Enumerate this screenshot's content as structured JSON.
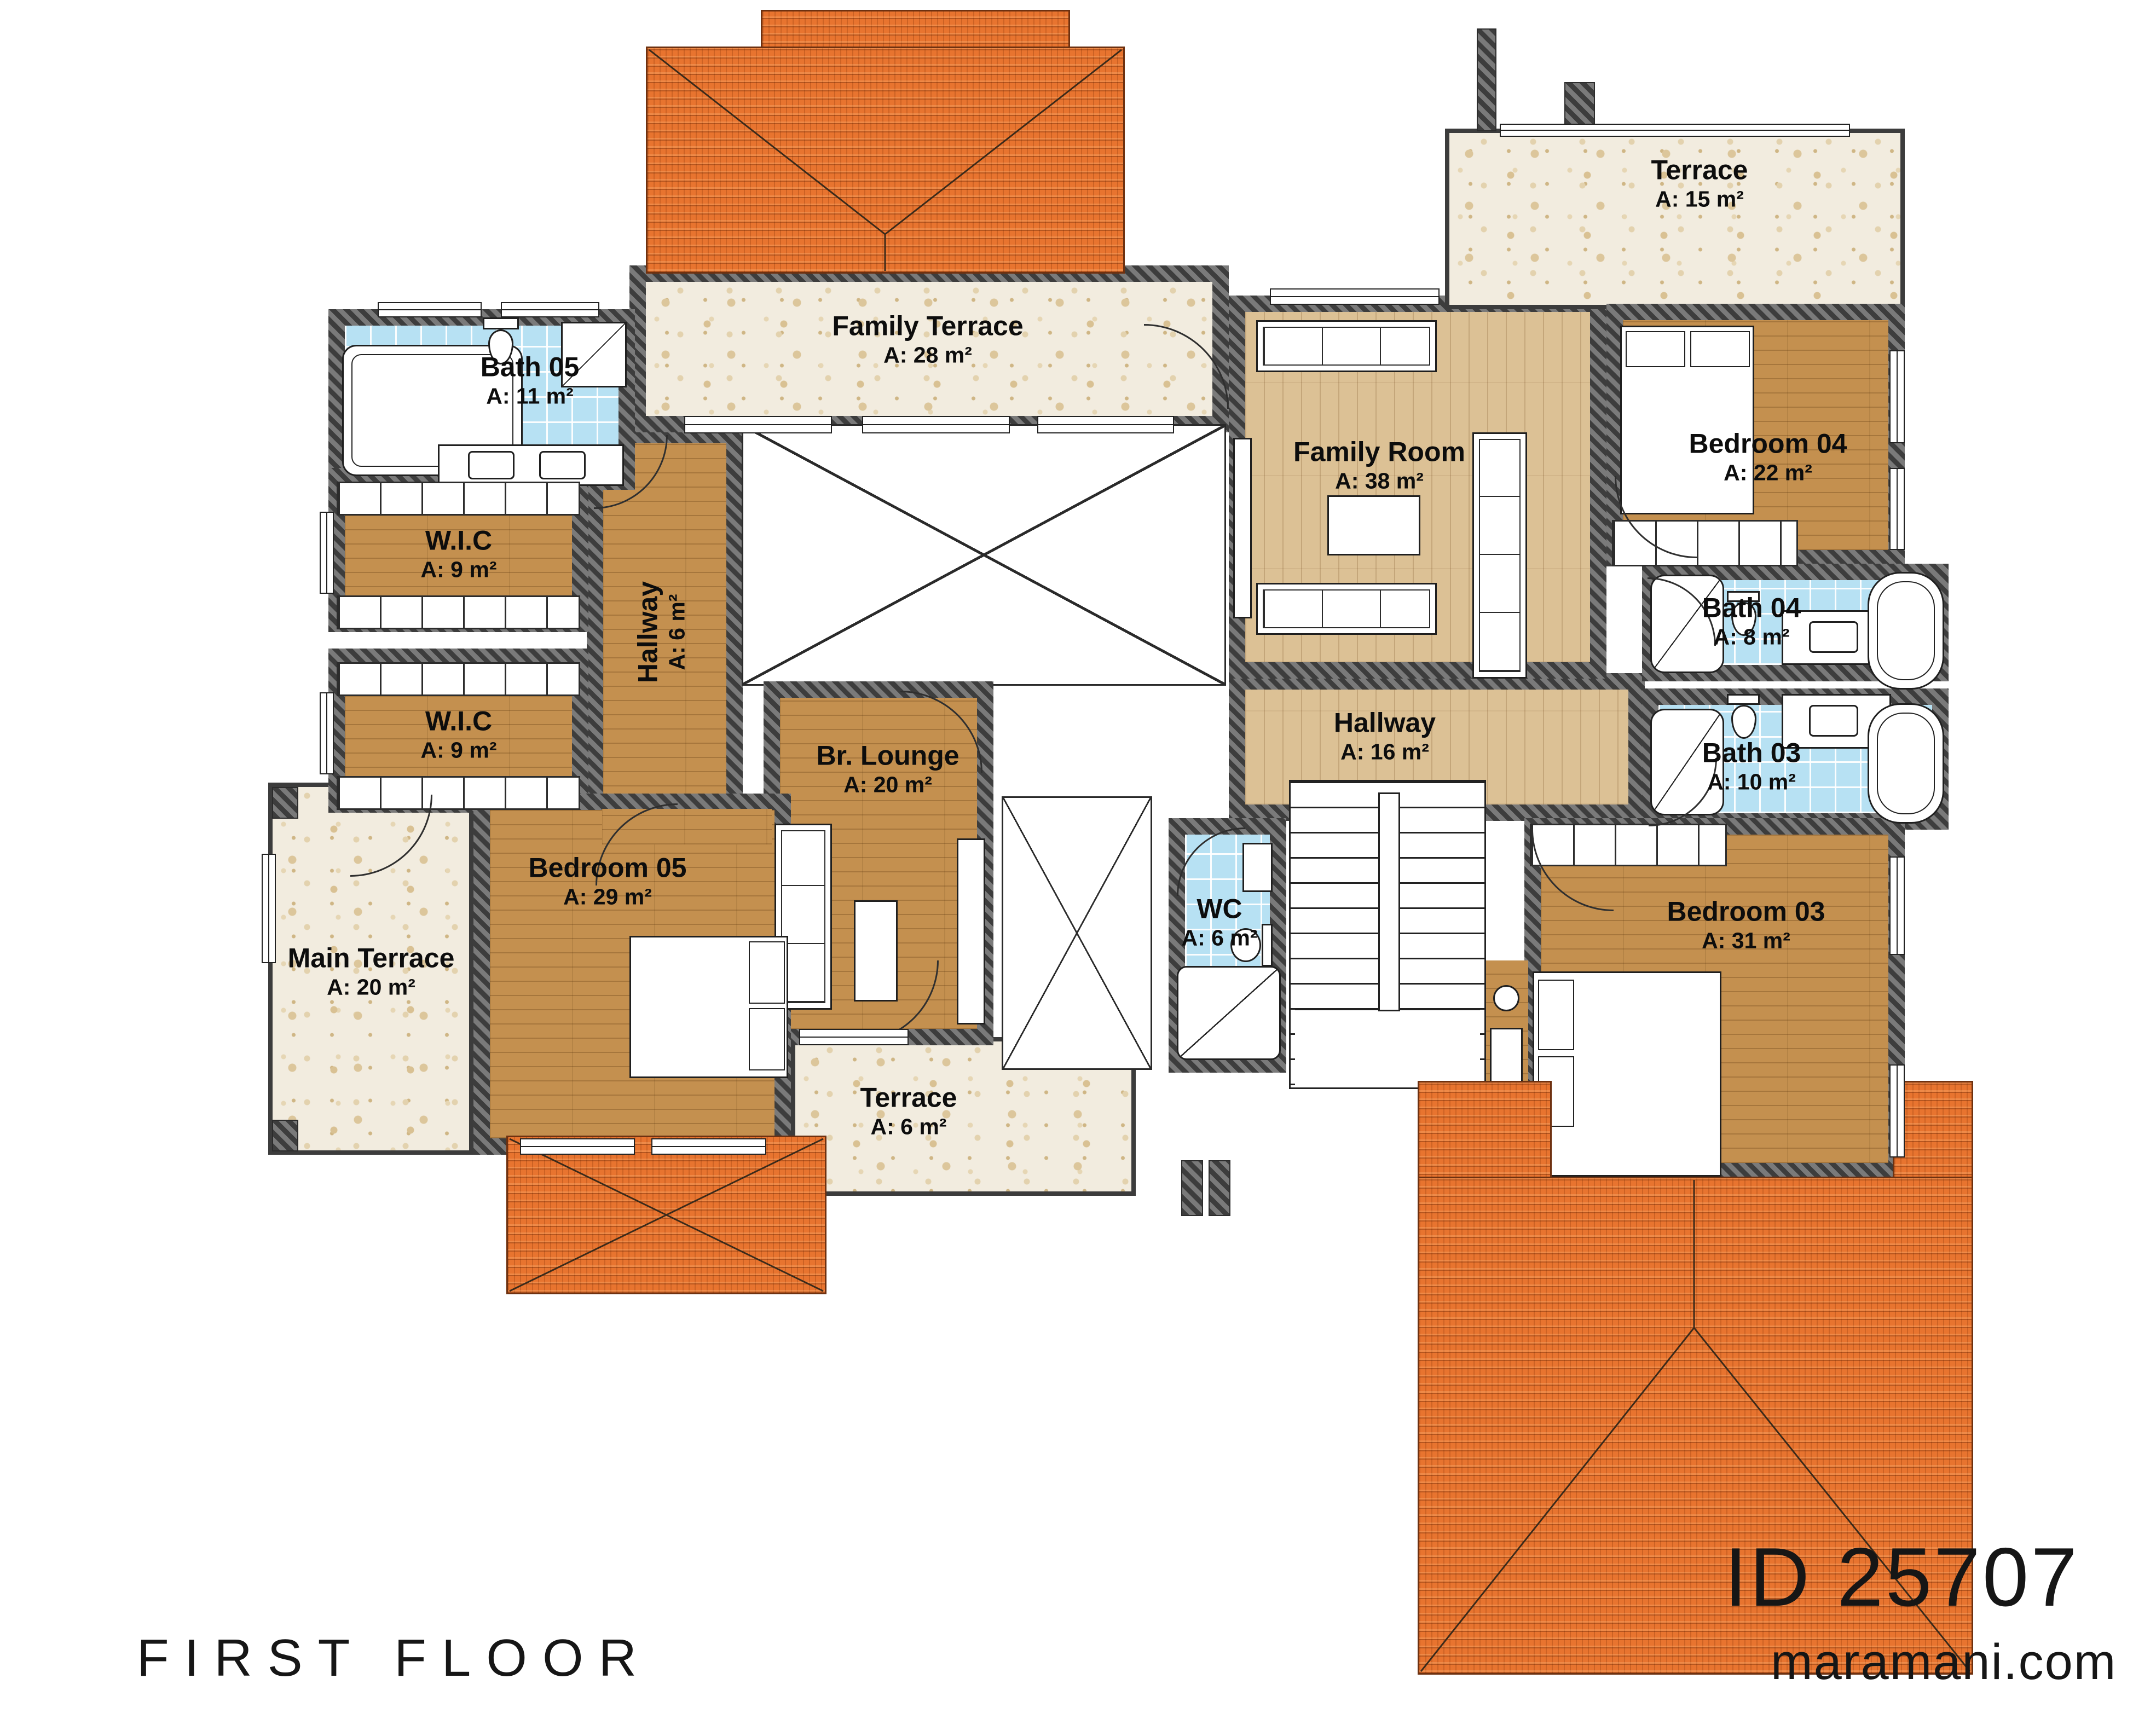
{
  "title_block": {
    "floor_label": "FIRST FLOOR",
    "plan_id": "ID 25707",
    "website": "maramani.com"
  },
  "rooms": [
    {
      "key": "bath-05",
      "name": "Bath 05",
      "area": "A: 11 m²"
    },
    {
      "key": "wic-upper",
      "name": "W.I.C",
      "area": "A: 9 m²"
    },
    {
      "key": "wic-lower",
      "name": "W.I.C",
      "area": "A: 9 m²"
    },
    {
      "key": "hallway-small",
      "name": "Hallway",
      "area": "A: 6 m²"
    },
    {
      "key": "family-terrace",
      "name": "Family Terrace",
      "area": "A: 28 m²"
    },
    {
      "key": "family-room",
      "name": "Family Room",
      "area": "A: 38 m²"
    },
    {
      "key": "terrace-upper",
      "name": "Terrace",
      "area": "A: 15 m²"
    },
    {
      "key": "bedroom-04",
      "name": "Bedroom 04",
      "area": "A: 22 m²"
    },
    {
      "key": "bath-04",
      "name": "Bath 04",
      "area": "A: 8 m²"
    },
    {
      "key": "bath-03",
      "name": "Bath 03",
      "area": "A: 10 m²"
    },
    {
      "key": "hallway-main",
      "name": "Hallway",
      "area": "A: 16 m²"
    },
    {
      "key": "br-lounge",
      "name": "Br. Lounge",
      "area": "A: 20 m²"
    },
    {
      "key": "bedroom-05",
      "name": "Bedroom 05",
      "area": "A: 29 m²"
    },
    {
      "key": "main-terrace",
      "name": "Main Terrace",
      "area": "A: 20 m²"
    },
    {
      "key": "wc",
      "name": "WC",
      "area": "A: 6 m²"
    },
    {
      "key": "terrace-lower",
      "name": "Terrace",
      "area": "A: 6 m²"
    },
    {
      "key": "bedroom-03",
      "name": "Bedroom 03",
      "area": "A: 31 m²"
    }
  ],
  "colors": {
    "roof": "#E8742F",
    "wall": "#4F4F4F",
    "bath_tile": "#B7E1F3",
    "wood_light": "#DCC195",
    "wood_honey": "#C4904F",
    "terrazzo": "#F2ECDF"
  }
}
